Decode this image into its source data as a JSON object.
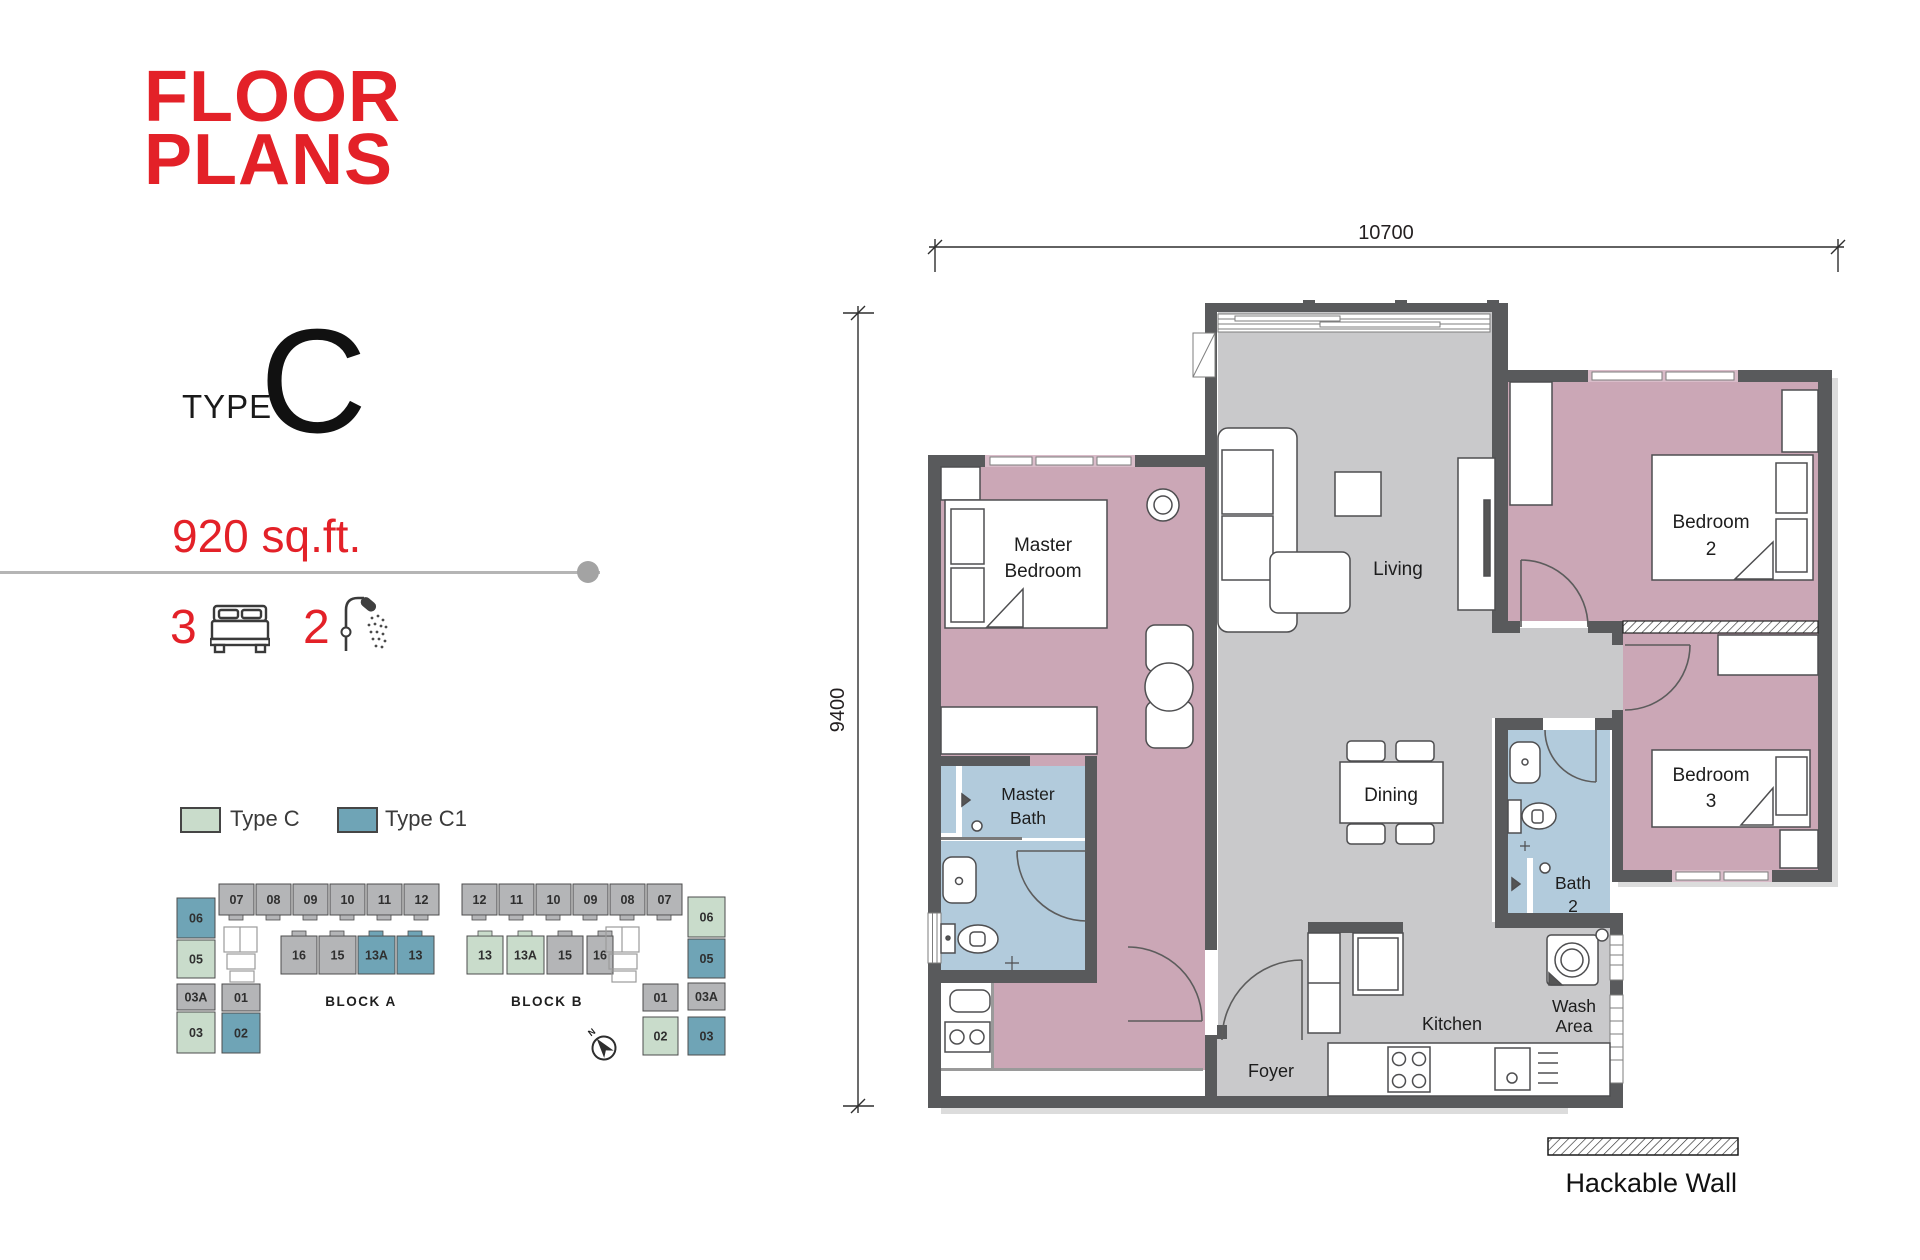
{
  "header": {
    "title_lines": [
      "FLOOR",
      "PLANS"
    ],
    "accent_color": "#e32128"
  },
  "unit": {
    "type_label": "TYPE",
    "type_letter": "C",
    "area": "920 sq.ft.",
    "bedrooms": "3",
    "bathrooms": "2"
  },
  "legend": {
    "type_c": {
      "label": "Type C",
      "color": "#c9dccb"
    },
    "type_c1": {
      "label": "Type C1",
      "color": "#6fa4b6"
    },
    "hackable_wall": {
      "label": "Hackable Wall"
    }
  },
  "blocks": {
    "unit_colors": {
      "c": "#c9dccb",
      "c1": "#6fa4b6",
      "other": "#b4b5b7"
    },
    "a": {
      "label": "BLOCK A",
      "top_row": [
        {
          "id": "07",
          "type": "other"
        },
        {
          "id": "08",
          "type": "other"
        },
        {
          "id": "09",
          "type": "other"
        },
        {
          "id": "10",
          "type": "other"
        },
        {
          "id": "11",
          "type": "other"
        },
        {
          "id": "12",
          "type": "other"
        }
      ],
      "mid_row": [
        {
          "id": "16",
          "type": "other"
        },
        {
          "id": "15",
          "type": "other"
        },
        {
          "id": "13A",
          "type": "c1"
        },
        {
          "id": "13",
          "type": "c1"
        }
      ],
      "left_col": [
        {
          "id": "06",
          "type": "c1"
        },
        {
          "id": "05",
          "type": "c"
        },
        {
          "id": "03A",
          "type": "other"
        },
        {
          "id": "03",
          "type": "c"
        }
      ],
      "inner_col": [
        {
          "id": "01",
          "type": "other"
        },
        {
          "id": "02",
          "type": "c1"
        }
      ]
    },
    "b": {
      "label": "BLOCK B",
      "top_row": [
        {
          "id": "12",
          "type": "other"
        },
        {
          "id": "11",
          "type": "other"
        },
        {
          "id": "10",
          "type": "other"
        },
        {
          "id": "09",
          "type": "other"
        },
        {
          "id": "08",
          "type": "other"
        },
        {
          "id": "07",
          "type": "other"
        }
      ],
      "mid_row": [
        {
          "id": "13",
          "type": "c"
        },
        {
          "id": "13A",
          "type": "c"
        },
        {
          "id": "15",
          "type": "other"
        },
        {
          "id": "16",
          "type": "other"
        }
      ],
      "inner_col": [
        {
          "id": "01",
          "type": "other"
        },
        {
          "id": "02",
          "type": "c"
        }
      ],
      "right_col": [
        {
          "id": "06",
          "type": "c"
        },
        {
          "id": "05",
          "type": "c1"
        },
        {
          "id": "03A",
          "type": "other"
        },
        {
          "id": "03",
          "type": "c1"
        }
      ]
    }
  },
  "compass": {
    "label": "N"
  },
  "floor_plan": {
    "dim_width": "10700",
    "dim_height": "9400",
    "colors": {
      "wall": "#595a5c",
      "bedroom": "#cba7b6",
      "living": "#c9c9cb",
      "bath": "#b2cbdc"
    },
    "rooms": {
      "master_bedroom": [
        "Master",
        "Bedroom"
      ],
      "living": [
        "Living"
      ],
      "bedroom2": [
        "Bedroom",
        "2"
      ],
      "bedroom3": [
        "Bedroom",
        "3"
      ],
      "master_bath": [
        "Master",
        "Bath"
      ],
      "dining": [
        "Dining"
      ],
      "bath2": [
        "Bath",
        "2"
      ],
      "kitchen": [
        "Kitchen"
      ],
      "wash_area": [
        "Wash",
        "Area"
      ],
      "foyer": [
        "Foyer"
      ]
    }
  }
}
